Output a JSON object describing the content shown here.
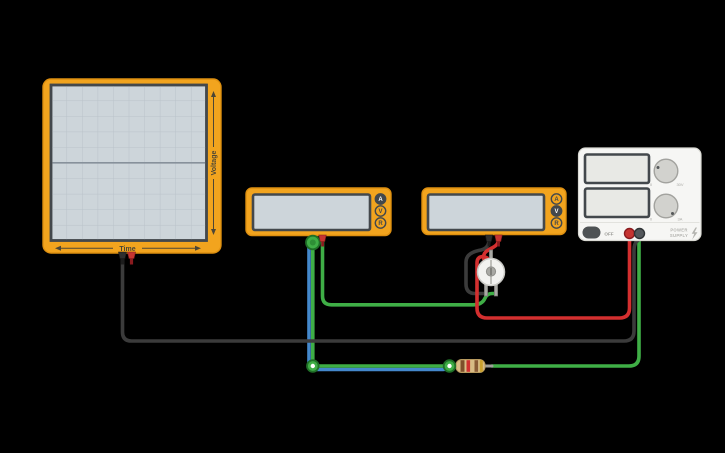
{
  "colors": {
    "background": "#000000",
    "device_orange": "#F2A41E",
    "device_orange_border": "#DD8F10",
    "screen_fill": "#CDD5DA",
    "screen_border": "#43484C",
    "grid_line": "#B9C2C9",
    "trace_line": "#87919B",
    "label_dark": "#4C4636",
    "wire_black": "#3B3B3B",
    "wire_red": "#D32F2F",
    "wire_green": "#3FAE46",
    "wire_green_dark": "#1F6F27",
    "wire_blue": "#4488CC",
    "lead_gray": "#9E9E9A",
    "ps_body": "#F6F6F4",
    "ps_screen": "#E8E9E5",
    "knob_fill": "#D2D2CE",
    "terminal_red": "#C63431",
    "terminal_dark": "#53575B"
  },
  "oscilloscope": {
    "x_axis_label": "Time",
    "y_axis_label": "Voltage",
    "display_value": ""
  },
  "multimeter_left": {
    "selected_mode": "A",
    "buttons": [
      "A",
      "V",
      "R"
    ],
    "display_value": ""
  },
  "multimeter_right": {
    "selected_mode": "V",
    "buttons": [
      "A",
      "V",
      "R"
    ],
    "display_value": ""
  },
  "power_supply": {
    "power_button_label": "OFF",
    "brand_line1": "POWER",
    "brand_line2": "SUPPLY",
    "voltage_knob": {
      "min_label": "0",
      "max_label": "30V"
    },
    "current_knob": {
      "min_label": "0",
      "max_label": "3A"
    },
    "top_display_value": "",
    "bottom_display_value": ""
  },
  "components": {
    "resistor": {
      "band_colors": [
        "#7D4F2B",
        "#D03030",
        "#8A5C36",
        "#CBA22E"
      ]
    }
  }
}
